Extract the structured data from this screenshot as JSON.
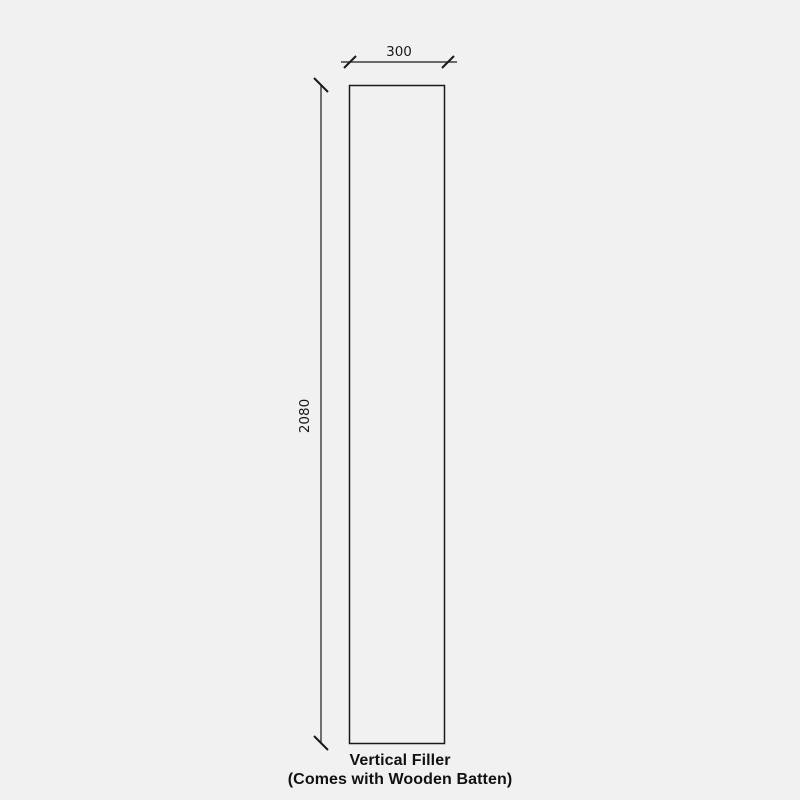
{
  "diagram": {
    "caption_line1": "Vertical Filler",
    "caption_line2": "(Comes with Wooden Batten)",
    "dimensions": {
      "width": {
        "label": "300"
      },
      "height": {
        "label": "2080"
      }
    },
    "colors": {
      "background": "#f1f1f2",
      "line": "#1a1a1a",
      "dimension_text": "#1a1a1a",
      "caption_text": "#111111"
    }
  }
}
